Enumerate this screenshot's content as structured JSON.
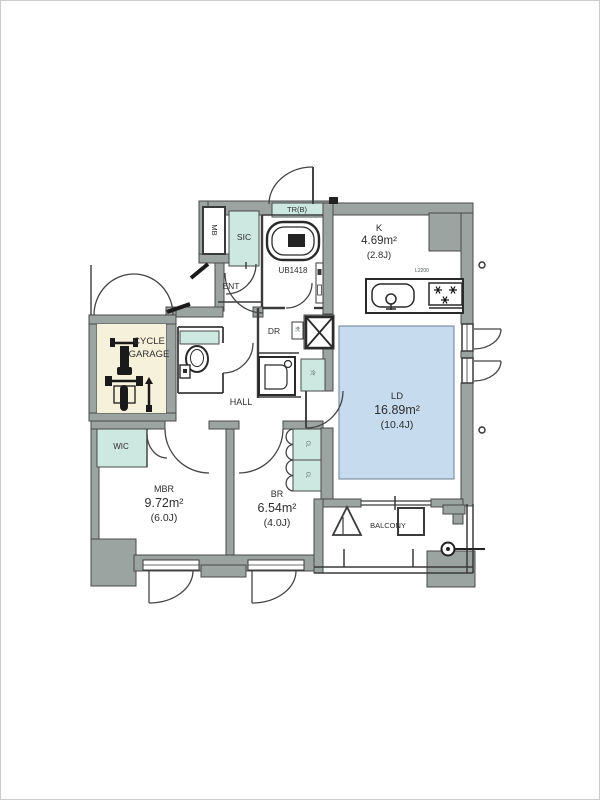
{
  "rooms": {
    "ld": {
      "name": "LD",
      "area": "16.89m²",
      "tatami": "(10.4J)"
    },
    "k": {
      "name": "K",
      "area": "4.69m²",
      "tatami": "(2.8J)"
    },
    "mbr": {
      "name": "MBR",
      "area": "9.72m²",
      "tatami": "(6.0J)"
    },
    "br": {
      "name": "BR",
      "area": "6.54m²",
      "tatami": "(4.0J)"
    },
    "hall": {
      "name": "HALL"
    },
    "ent": {
      "name": "ENT"
    },
    "dr": {
      "name": "DR"
    },
    "wic": {
      "name": "WIC"
    },
    "sic": {
      "name": "SIC"
    },
    "mb": {
      "name": "MB"
    },
    "trunk": {
      "name": "TR(B)"
    },
    "bath": {
      "name": "UB1418"
    },
    "balcony": {
      "name": "BALCONY"
    },
    "cycle_garage": {
      "line1": "CYCLE",
      "line2": "GARAGE"
    }
  },
  "labels": {
    "counter_length": "L2200",
    "closet": "CL",
    "fridge": "冷",
    "laundry": "洗"
  },
  "colors": {
    "wall_gray": "#9ba4a0",
    "accent_teal": "#cde7e1",
    "ld_floor_blue": "#c6dbee",
    "cycle_garage_cream": "#f5f1da",
    "line_dark": "#3a3a3a"
  }
}
